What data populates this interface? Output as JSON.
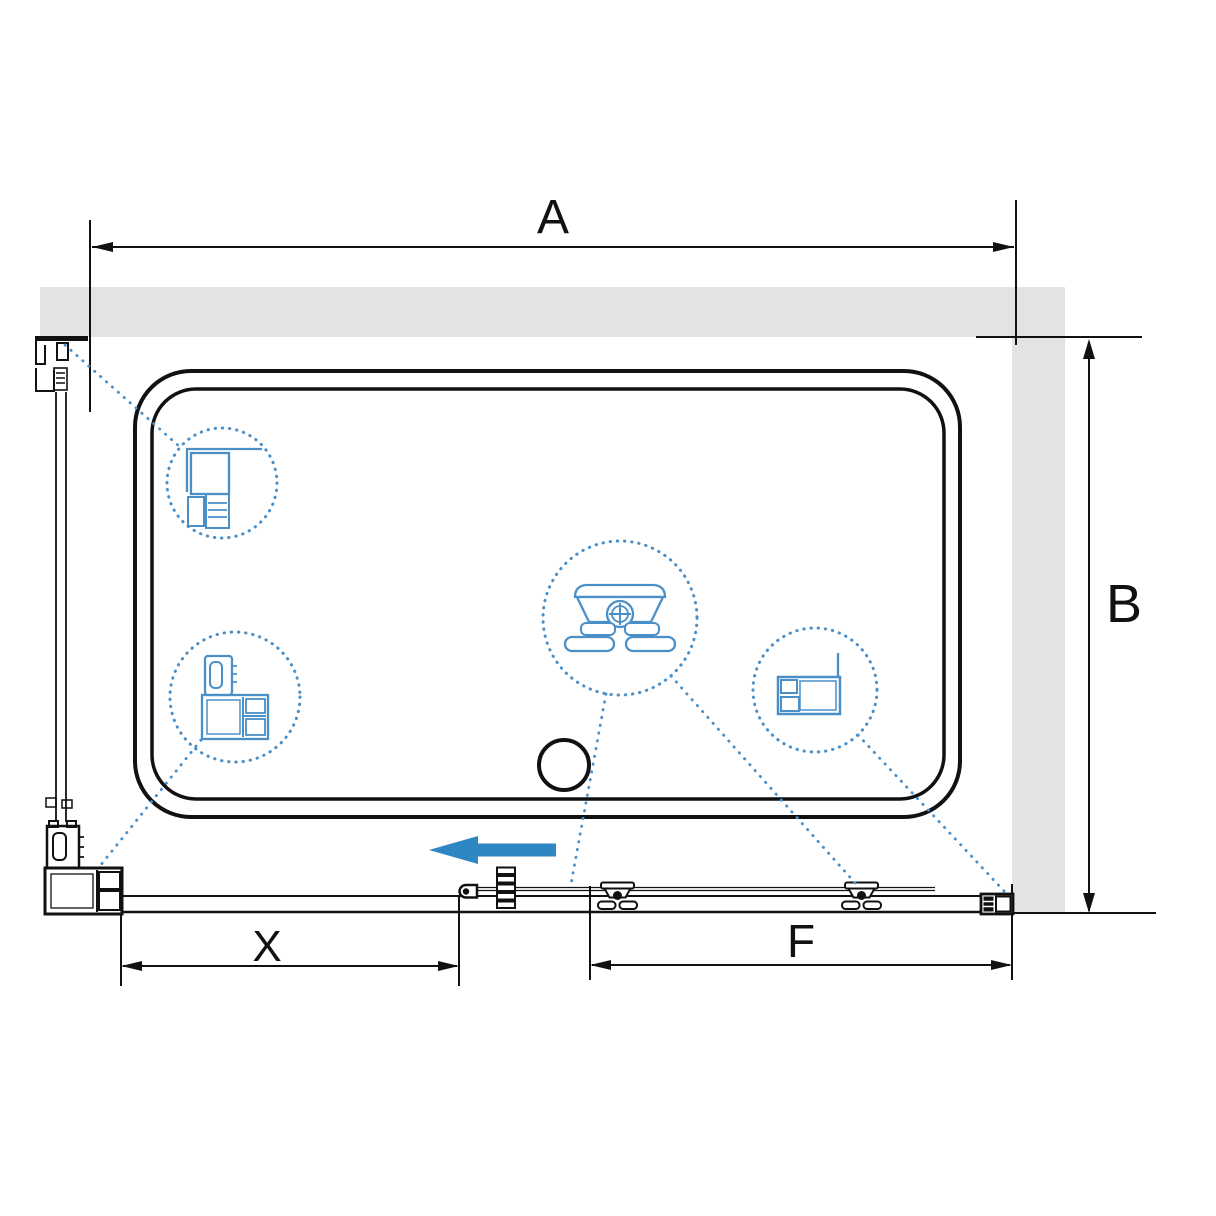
{
  "diagram": {
    "type": "shower-enclosure-top-view-installation-scheme",
    "dimension_labels": {
      "width": "A",
      "depth": "B",
      "door_opening": "X",
      "fixed_segment": "F"
    },
    "arrow": {
      "direction": "left"
    },
    "colors": {
      "wall": "#e3e3e3",
      "line": "#111111",
      "blue": "#4a8fc8",
      "arrow": "#2e86c3"
    }
  }
}
